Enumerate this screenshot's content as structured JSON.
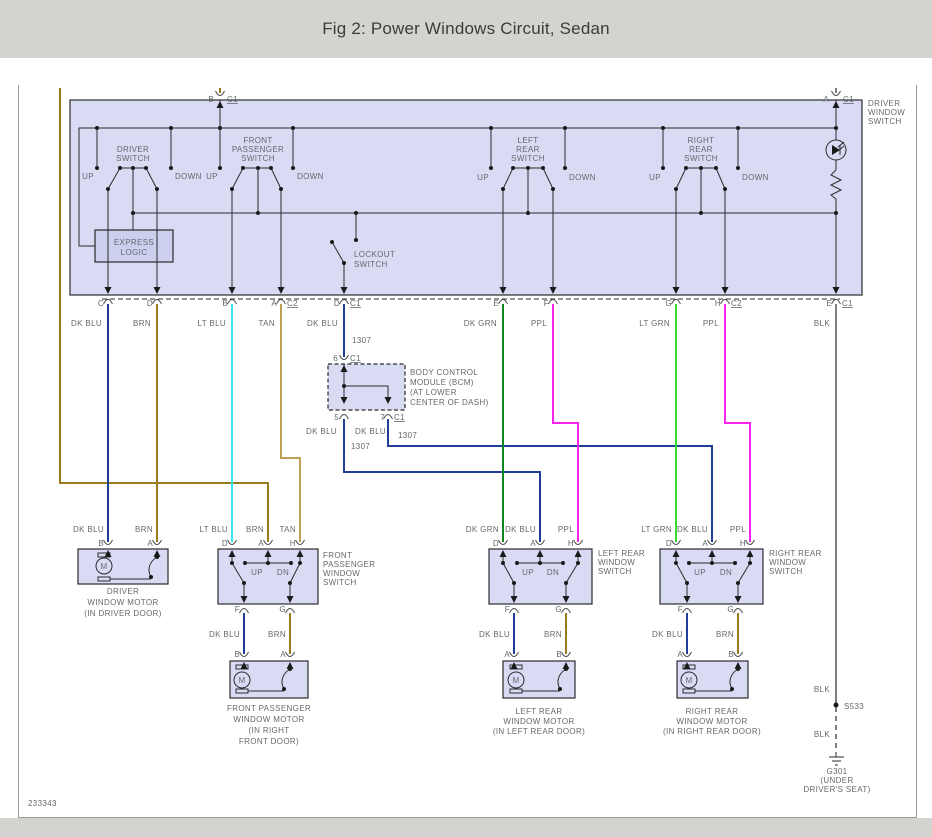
{
  "title": "Fig 2: Power Windows Circuit, Sedan",
  "drawing_number": "233343",
  "colors": {
    "page": "#d5d3cf",
    "line": "#2b2b2b",
    "text": "#64696e",
    "frame": "#9a9a9a",
    "box_fill": "#d9dbf4",
    "box_fill2": "#cdcfee",
    "dk_blu": "#1f3d99",
    "brn": "#9a7b1d",
    "tan": "#bf9f55",
    "lt_blu": "#35e3ee",
    "dk_grn": "#0e861e",
    "lt_grn": "#32da32",
    "ppl": "#f824ee",
    "blk": "#7f7f7f"
  },
  "labels": [
    {
      "n": "pin-label",
      "t": "B",
      "x": 214,
      "y": 102,
      "a": "e"
    },
    {
      "n": "connector-label",
      "t": "C1",
      "x": 227,
      "y": 102,
      "a": "s",
      "u": 1
    },
    {
      "n": "pin-label",
      "t": "A",
      "x": 829,
      "y": 102,
      "a": "e"
    },
    {
      "n": "connector-label",
      "t": "C1",
      "x": 843,
      "y": 102,
      "a": "s",
      "u": 1
    },
    {
      "n": "driver-switch-name",
      "t": "DRIVER",
      "x": 133,
      "y": 152
    },
    {
      "n": "driver-switch-name",
      "t": "SWITCH",
      "x": 133,
      "y": 161
    },
    {
      "n": "front-passenger-switch-name",
      "t": "FRONT",
      "x": 258,
      "y": 143
    },
    {
      "n": "front-passenger-switch-name",
      "t": "PASSENGER",
      "x": 258,
      "y": 152
    },
    {
      "n": "front-passenger-switch-name",
      "t": "SWITCH",
      "x": 258,
      "y": 161
    },
    {
      "n": "left-rear-switch-name",
      "t": "LEFT",
      "x": 528,
      "y": 143
    },
    {
      "n": "left-rear-switch-name",
      "t": "REAR",
      "x": 528,
      "y": 152
    },
    {
      "n": "left-rear-switch-name",
      "t": "SWITCH",
      "x": 528,
      "y": 161
    },
    {
      "n": "right-rear-switch-name",
      "t": "RIGHT",
      "x": 701,
      "y": 143
    },
    {
      "n": "right-rear-switch-name",
      "t": "REAR",
      "x": 701,
      "y": 152
    },
    {
      "n": "right-rear-switch-name",
      "t": "SWITCH",
      "x": 701,
      "y": 161
    },
    {
      "n": "up-label",
      "t": "UP",
      "x": 94,
      "y": 179,
      "a": "e"
    },
    {
      "n": "down-label",
      "t": "DOWN",
      "x": 175,
      "y": 179,
      "a": "s"
    },
    {
      "n": "up-label",
      "t": "UP",
      "x": 218,
      "y": 179,
      "a": "e"
    },
    {
      "n": "down-label",
      "t": "DOWN",
      "x": 297,
      "y": 179,
      "a": "s"
    },
    {
      "n": "up-label",
      "t": "UP",
      "x": 489,
      "y": 180,
      "a": "e"
    },
    {
      "n": "down-label",
      "t": "DOWN",
      "x": 569,
      "y": 180,
      "a": "s"
    },
    {
      "n": "up-label",
      "t": "UP",
      "x": 661,
      "y": 180,
      "a": "e"
    },
    {
      "n": "down-label",
      "t": "DOWN",
      "x": 742,
      "y": 180,
      "a": "s"
    },
    {
      "n": "driver-window-switch-name",
      "t": "DRIVER",
      "x": 868,
      "y": 106,
      "a": "s"
    },
    {
      "n": "driver-window-switch-name",
      "t": "WINDOW",
      "x": 868,
      "y": 115,
      "a": "s"
    },
    {
      "n": "driver-window-switch-name",
      "t": "SWITCH",
      "x": 868,
      "y": 124,
      "a": "s"
    },
    {
      "n": "express-logic-name",
      "t": "EXPRESS",
      "x": 134,
      "y": 245
    },
    {
      "n": "express-logic-name",
      "t": "LOGIC",
      "x": 134,
      "y": 255
    },
    {
      "n": "lockout-switch-name",
      "t": "LOCKOUT",
      "x": 354,
      "y": 257,
      "a": "s"
    },
    {
      "n": "lockout-switch-name",
      "t": "SWITCH",
      "x": 354,
      "y": 267,
      "a": "s"
    },
    {
      "n": "pin-label",
      "t": "C",
      "x": 104,
      "y": 306,
      "a": "e"
    },
    {
      "n": "pin-label",
      "t": "D",
      "x": 153,
      "y": 306,
      "a": "e"
    },
    {
      "n": "pin-label",
      "t": "B",
      "x": 228,
      "y": 306,
      "a": "e"
    },
    {
      "n": "pin-label",
      "t": "A",
      "x": 277,
      "y": 306,
      "a": "e"
    },
    {
      "n": "connector-label",
      "t": "C2",
      "x": 287,
      "y": 306,
      "a": "s",
      "u": 1
    },
    {
      "n": "pin-label",
      "t": "D",
      "x": 340,
      "y": 306,
      "a": "e"
    },
    {
      "n": "connector-label",
      "t": "C1",
      "x": 350,
      "y": 306,
      "a": "s",
      "u": 1
    },
    {
      "n": "pin-label",
      "t": "E",
      "x": 499,
      "y": 306,
      "a": "e"
    },
    {
      "n": "pin-label",
      "t": "F",
      "x": 549,
      "y": 306,
      "a": "e"
    },
    {
      "n": "pin-label",
      "t": "G",
      "x": 672,
      "y": 306,
      "a": "e"
    },
    {
      "n": "pin-label",
      "t": "H",
      "x": 721,
      "y": 306,
      "a": "e"
    },
    {
      "n": "connector-label",
      "t": "C2",
      "x": 731,
      "y": 306,
      "a": "s",
      "u": 1
    },
    {
      "n": "pin-label",
      "t": "E",
      "x": 832,
      "y": 306,
      "a": "e"
    },
    {
      "n": "connector-label",
      "t": "C1",
      "x": 842,
      "y": 306,
      "a": "s",
      "u": 1
    },
    {
      "n": "wire-color-label",
      "t": "DK BLU",
      "x": 102,
      "y": 326,
      "a": "e"
    },
    {
      "n": "wire-color-label",
      "t": "BRN",
      "x": 151,
      "y": 326,
      "a": "e"
    },
    {
      "n": "wire-color-label",
      "t": "LT BLU",
      "x": 226,
      "y": 326,
      "a": "e"
    },
    {
      "n": "wire-color-label",
      "t": "TAN",
      "x": 275,
      "y": 326,
      "a": "e"
    },
    {
      "n": "wire-color-label",
      "t": "DK BLU",
      "x": 338,
      "y": 326,
      "a": "e"
    },
    {
      "n": "circuit-number",
      "t": "1307",
      "x": 352,
      "y": 343,
      "a": "s"
    },
    {
      "n": "wire-color-label",
      "t": "DK GRN",
      "x": 497,
      "y": 326,
      "a": "e"
    },
    {
      "n": "wire-color-label",
      "t": "PPL",
      "x": 547,
      "y": 326,
      "a": "e"
    },
    {
      "n": "wire-color-label",
      "t": "LT GRN",
      "x": 670,
      "y": 326,
      "a": "e"
    },
    {
      "n": "wire-color-label",
      "t": "PPL",
      "x": 719,
      "y": 326,
      "a": "e"
    },
    {
      "n": "wire-color-label",
      "t": "BLK",
      "x": 830,
      "y": 326,
      "a": "e"
    },
    {
      "n": "pin-label",
      "t": "6",
      "x": 338,
      "y": 361,
      "a": "e"
    },
    {
      "n": "connector-label",
      "t": "C1",
      "x": 350,
      "y": 361,
      "a": "s",
      "u": 1
    },
    {
      "n": "bcm-name",
      "t": "BODY CONTROL",
      "x": 410,
      "y": 375,
      "a": "s"
    },
    {
      "n": "bcm-name",
      "t": "MODULE (BCM)",
      "x": 410,
      "y": 385,
      "a": "s"
    },
    {
      "n": "bcm-location",
      "t": "(AT LOWER",
      "x": 410,
      "y": 395,
      "a": "s"
    },
    {
      "n": "bcm-location",
      "t": "CENTER OF DASH)",
      "x": 410,
      "y": 405,
      "a": "s"
    },
    {
      "n": "pin-label",
      "t": "5",
      "x": 339,
      "y": 420,
      "a": "e"
    },
    {
      "n": "pin-label",
      "t": "7",
      "x": 385,
      "y": 420,
      "a": "e"
    },
    {
      "n": "connector-label",
      "t": "C1",
      "x": 394,
      "y": 420,
      "a": "s",
      "u": 1
    },
    {
      "n": "wire-color-label",
      "t": "DK BLU",
      "x": 337,
      "y": 434,
      "a": "e"
    },
    {
      "n": "wire-color-label",
      "t": "DK BLU",
      "x": 386,
      "y": 434,
      "a": "e"
    },
    {
      "n": "circuit-number",
      "t": "1307",
      "x": 398,
      "y": 438,
      "a": "s"
    },
    {
      "n": "circuit-number",
      "t": "1307",
      "x": 351,
      "y": 449,
      "a": "s"
    },
    {
      "n": "wire-color-label",
      "t": "DK BLU",
      "x": 104,
      "y": 532,
      "a": "e"
    },
    {
      "n": "wire-color-label",
      "t": "BRN",
      "x": 153,
      "y": 532,
      "a": "e"
    },
    {
      "n": "wire-color-label",
      "t": "LT BLU",
      "x": 228,
      "y": 532,
      "a": "e"
    },
    {
      "n": "wire-color-label",
      "t": "BRN",
      "x": 264,
      "y": 532,
      "a": "e"
    },
    {
      "n": "wire-color-label",
      "t": "TAN",
      "x": 296,
      "y": 532,
      "a": "e"
    },
    {
      "n": "wire-color-label",
      "t": "DK GRN",
      "x": 499,
      "y": 532,
      "a": "e"
    },
    {
      "n": "wire-color-label",
      "t": "DK BLU",
      "x": 536,
      "y": 532,
      "a": "e"
    },
    {
      "n": "wire-color-label",
      "t": "PPL",
      "x": 574,
      "y": 532,
      "a": "e"
    },
    {
      "n": "wire-color-label",
      "t": "LT GRN",
      "x": 672,
      "y": 532,
      "a": "e"
    },
    {
      "n": "wire-color-label",
      "t": "DK BLU",
      "x": 708,
      "y": 532,
      "a": "e"
    },
    {
      "n": "wire-color-label",
      "t": "PPL",
      "x": 746,
      "y": 532,
      "a": "e"
    },
    {
      "n": "pin-label",
      "t": "B",
      "x": 104,
      "y": 546,
      "a": "e"
    },
    {
      "n": "pin-label",
      "t": "A",
      "x": 153,
      "y": 546,
      "a": "e"
    },
    {
      "n": "pin-label",
      "t": "D",
      "x": 228,
      "y": 546,
      "a": "e"
    },
    {
      "n": "pin-label",
      "t": "A",
      "x": 264,
      "y": 546,
      "a": "e"
    },
    {
      "n": "pin-label",
      "t": "H",
      "x": 296,
      "y": 546,
      "a": "e"
    },
    {
      "n": "pin-label",
      "t": "D",
      "x": 499,
      "y": 546,
      "a": "e"
    },
    {
      "n": "pin-label",
      "t": "A",
      "x": 536,
      "y": 546,
      "a": "e"
    },
    {
      "n": "pin-label",
      "t": "H",
      "x": 574,
      "y": 546,
      "a": "e"
    },
    {
      "n": "pin-label",
      "t": "D",
      "x": 672,
      "y": 546,
      "a": "e"
    },
    {
      "n": "pin-label",
      "t": "A",
      "x": 708,
      "y": 546,
      "a": "e"
    },
    {
      "n": "pin-label",
      "t": "H",
      "x": 746,
      "y": 546,
      "a": "e"
    },
    {
      "n": "up-label",
      "t": "UP",
      "x": 257,
      "y": 575
    },
    {
      "n": "down-label",
      "t": "DN",
      "x": 283,
      "y": 575
    },
    {
      "n": "up-label",
      "t": "UP",
      "x": 528,
      "y": 575
    },
    {
      "n": "down-label",
      "t": "DN",
      "x": 553,
      "y": 575
    },
    {
      "n": "up-label",
      "t": "UP",
      "x": 700,
      "y": 575
    },
    {
      "n": "down-label",
      "t": "DN",
      "x": 726,
      "y": 575
    },
    {
      "n": "pin-label",
      "t": "F",
      "x": 240,
      "y": 612,
      "a": "e"
    },
    {
      "n": "pin-label",
      "t": "G",
      "x": 286,
      "y": 612,
      "a": "e"
    },
    {
      "n": "pin-label",
      "t": "F",
      "x": 510,
      "y": 612,
      "a": "e"
    },
    {
      "n": "pin-label",
      "t": "G",
      "x": 562,
      "y": 612,
      "a": "e"
    },
    {
      "n": "pin-label",
      "t": "F",
      "x": 683,
      "y": 612,
      "a": "e"
    },
    {
      "n": "pin-label",
      "t": "G",
      "x": 734,
      "y": 612,
      "a": "e"
    },
    {
      "n": "wire-color-label",
      "t": "DK BLU",
      "x": 240,
      "y": 637,
      "a": "e"
    },
    {
      "n": "wire-color-label",
      "t": "BRN",
      "x": 286,
      "y": 637,
      "a": "e"
    },
    {
      "n": "wire-color-label",
      "t": "DK BLU",
      "x": 510,
      "y": 637,
      "a": "e"
    },
    {
      "n": "wire-color-label",
      "t": "BRN",
      "x": 562,
      "y": 637,
      "a": "e"
    },
    {
      "n": "wire-color-label",
      "t": "DK BLU",
      "x": 683,
      "y": 637,
      "a": "e"
    },
    {
      "n": "wire-color-label",
      "t": "BRN",
      "x": 734,
      "y": 637,
      "a": "e"
    },
    {
      "n": "pin-label",
      "t": "B",
      "x": 240,
      "y": 657,
      "a": "e"
    },
    {
      "n": "pin-label",
      "t": "A",
      "x": 286,
      "y": 657,
      "a": "e"
    },
    {
      "n": "pin-label",
      "t": "A",
      "x": 510,
      "y": 657,
      "a": "e"
    },
    {
      "n": "pin-label",
      "t": "B",
      "x": 562,
      "y": 657,
      "a": "e"
    },
    {
      "n": "pin-label",
      "t": "A",
      "x": 683,
      "y": 657,
      "a": "e"
    },
    {
      "n": "pin-label",
      "t": "B",
      "x": 734,
      "y": 657,
      "a": "e"
    },
    {
      "n": "front-passenger-window-switch-name",
      "t": "FRONT",
      "x": 323,
      "y": 558,
      "a": "s"
    },
    {
      "n": "front-passenger-window-switch-name",
      "t": "PASSENGER",
      "x": 323,
      "y": 567,
      "a": "s"
    },
    {
      "n": "front-passenger-window-switch-name",
      "t": "WINDOW",
      "x": 323,
      "y": 576,
      "a": "s"
    },
    {
      "n": "front-passenger-window-switch-name",
      "t": "SWITCH",
      "x": 323,
      "y": 585,
      "a": "s"
    },
    {
      "n": "left-rear-window-switch-name",
      "t": "LEFT REAR",
      "x": 598,
      "y": 556,
      "a": "s"
    },
    {
      "n": "left-rear-window-switch-name",
      "t": "WINDOW",
      "x": 598,
      "y": 565,
      "a": "s"
    },
    {
      "n": "left-rear-window-switch-name",
      "t": "SWITCH",
      "x": 598,
      "y": 574,
      "a": "s"
    },
    {
      "n": "right-rear-window-switch-name",
      "t": "RIGHT REAR",
      "x": 769,
      "y": 556,
      "a": "s"
    },
    {
      "n": "right-rear-window-switch-name",
      "t": "WINDOW",
      "x": 769,
      "y": 565,
      "a": "s"
    },
    {
      "n": "right-rear-window-switch-name",
      "t": "SWITCH",
      "x": 769,
      "y": 574,
      "a": "s"
    },
    {
      "n": "driver-window-motor-name",
      "t": "DRIVER",
      "x": 123,
      "y": 594
    },
    {
      "n": "driver-window-motor-name",
      "t": "WINDOW MOTOR",
      "x": 123,
      "y": 605
    },
    {
      "n": "driver-window-motor-location",
      "t": "(IN DRIVER DOOR)",
      "x": 123,
      "y": 616
    },
    {
      "n": "front-passenger-window-motor-name",
      "t": "FRONT PASSENGER",
      "x": 269,
      "y": 711
    },
    {
      "n": "front-passenger-window-motor-name",
      "t": "WINDOW MOTOR",
      "x": 269,
      "y": 722
    },
    {
      "n": "front-passenger-window-motor-location",
      "t": "(IN RIGHT",
      "x": 269,
      "y": 733
    },
    {
      "n": "front-passenger-window-motor-location",
      "t": "FRONT DOOR)",
      "x": 269,
      "y": 744
    },
    {
      "n": "left-rear-window-motor-name",
      "t": "LEFT REAR",
      "x": 539,
      "y": 714
    },
    {
      "n": "left-rear-window-motor-name",
      "t": "WINDOW MOTOR",
      "x": 539,
      "y": 724
    },
    {
      "n": "left-rear-window-motor-location",
      "t": "(IN LEFT REAR DOOR)",
      "x": 539,
      "y": 734
    },
    {
      "n": "right-rear-window-motor-name",
      "t": "RIGHT REAR",
      "x": 712,
      "y": 714
    },
    {
      "n": "right-rear-window-motor-name",
      "t": "WINDOW MOTOR",
      "x": 712,
      "y": 724
    },
    {
      "n": "right-rear-window-motor-location",
      "t": "(IN RIGHT REAR DOOR)",
      "x": 712,
      "y": 734
    },
    {
      "n": "wire-color-label",
      "t": "BLK",
      "x": 830,
      "y": 692,
      "a": "e"
    },
    {
      "n": "splice-label",
      "t": "S533",
      "x": 844,
      "y": 709,
      "a": "s"
    },
    {
      "n": "wire-color-label",
      "t": "BLK",
      "x": 830,
      "y": 737,
      "a": "e"
    },
    {
      "n": "ground-label",
      "t": "G301",
      "x": 837,
      "y": 774
    },
    {
      "n": "ground-location",
      "t": "(UNDER",
      "x": 837,
      "y": 783
    },
    {
      "n": "ground-location",
      "t": "DRIVER'S SEAT)",
      "x": 837,
      "y": 792
    },
    {
      "n": "motor-symbol-letter",
      "t": "M",
      "x": 104,
      "y": 569,
      "c": "line",
      "f": 9
    },
    {
      "n": "motor-symbol-letter",
      "t": "M",
      "x": 242,
      "y": 683,
      "c": "line",
      "f": 9
    },
    {
      "n": "motor-symbol-letter",
      "t": "M",
      "x": 516,
      "y": 683,
      "c": "line",
      "f": 9
    },
    {
      "n": "motor-symbol-letter",
      "t": "M",
      "x": 689,
      "y": 683,
      "c": "line",
      "f": 9
    },
    {
      "n": "drawing-number",
      "t": "233343",
      "x": 28,
      "y": 806,
      "a": "s",
      "f": 7
    }
  ]
}
